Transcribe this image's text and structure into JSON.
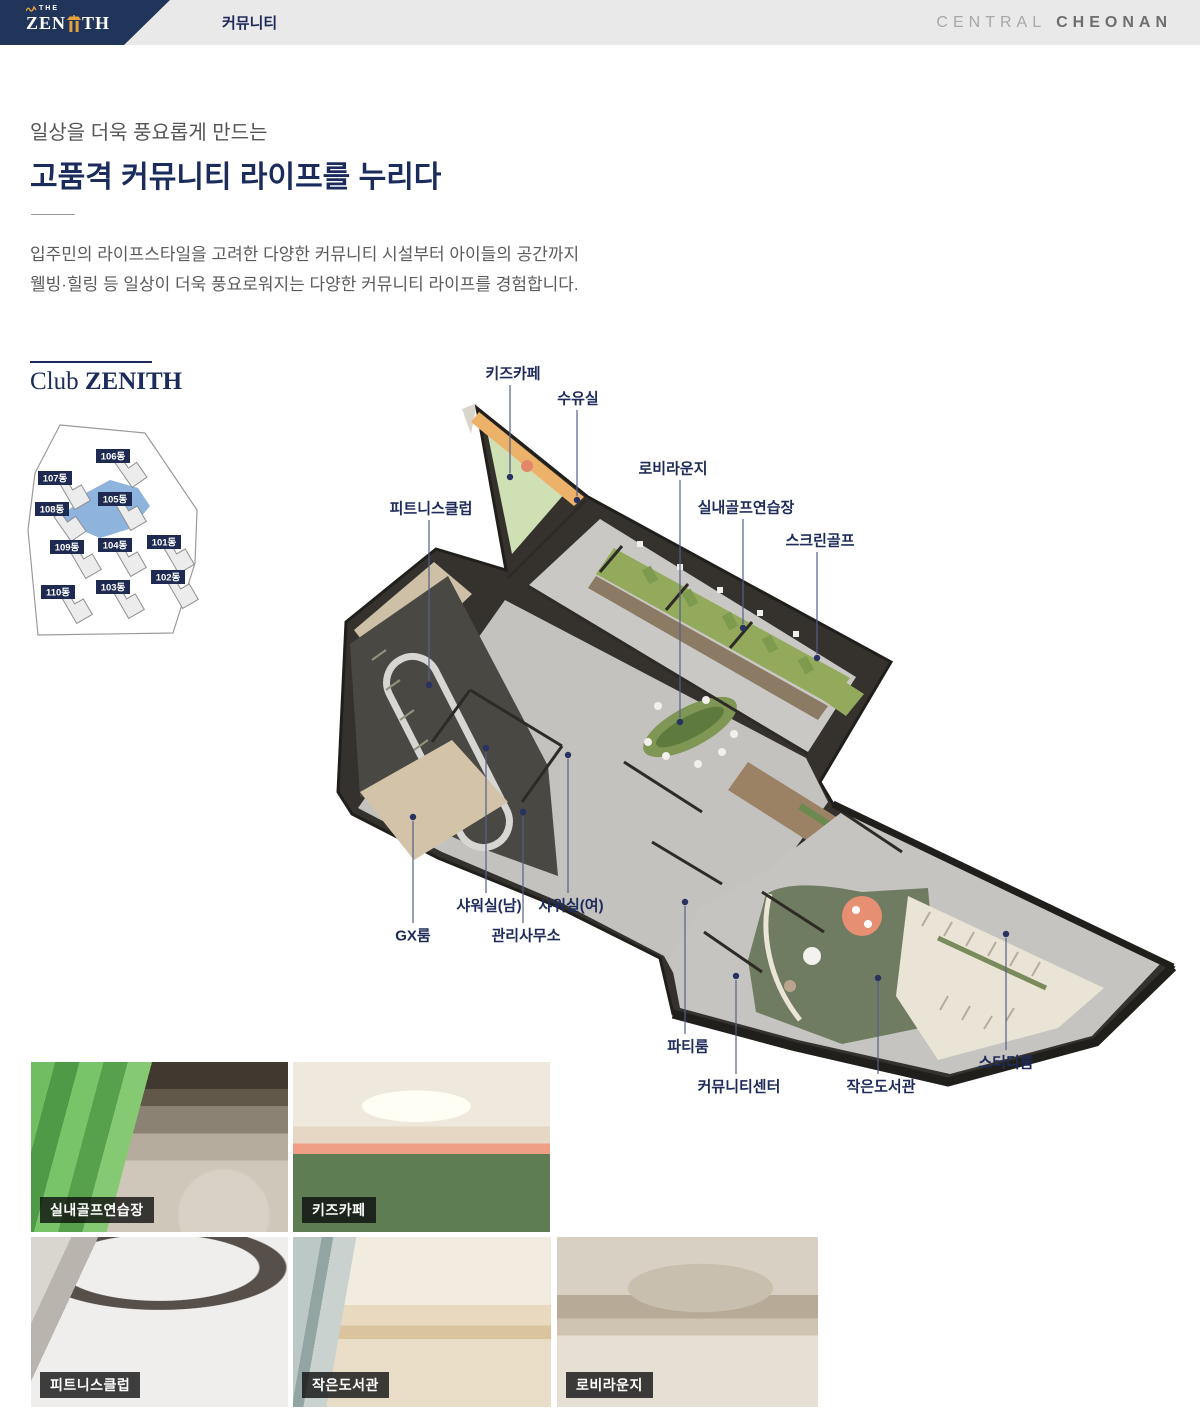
{
  "header": {
    "logo_the": "THE",
    "logo_zen": "ZEN",
    "logo_th": "TH",
    "tab": "커뮤니티",
    "brand_light": "CENTRAL",
    "brand_bold": "CHEONAN"
  },
  "intro": {
    "eyebrow": "일상을 더욱 풍요롭게 만드는",
    "title": "고품격 커뮤니티 라이프를 누리다",
    "body_line1": "입주민의 라이프스타일을 고려한 다양한 커뮤니티 시설부터 아이들의 공간까지",
    "body_line2": "웰빙·힐링 등 일상이 더욱 풍요로워지는 다양한 커뮤니티 라이프를 경험합니다."
  },
  "club": {
    "title_regular": "Club ",
    "title_bold": "ZENITH"
  },
  "site_map": {
    "highlighted": "105동",
    "buildings": [
      {
        "label": "106동",
        "x": 113,
        "y": 456,
        "gx": 131,
        "gy": 470,
        "rot": -35
      },
      {
        "label": "107동",
        "x": 55,
        "y": 478,
        "gx": 75,
        "gy": 492,
        "rot": -30
      },
      {
        "label": "105동",
        "x": 115,
        "y": 499,
        "gx": 131,
        "gy": 513,
        "rot": -30
      },
      {
        "label": "108동",
        "x": 52,
        "y": 509,
        "gx": 70,
        "gy": 524,
        "rot": -35
      },
      {
        "label": "109동",
        "x": 67,
        "y": 547,
        "gx": 86,
        "gy": 561,
        "rot": -30
      },
      {
        "label": "104동",
        "x": 115,
        "y": 545,
        "gx": 131,
        "gy": 559,
        "rot": -30
      },
      {
        "label": "101동",
        "x": 164,
        "y": 542,
        "gx": 179,
        "gy": 556,
        "rot": -30
      },
      {
        "label": "102동",
        "x": 168,
        "y": 577,
        "gx": 183,
        "gy": 591,
        "rot": -30
      },
      {
        "label": "103동",
        "x": 113,
        "y": 587,
        "gx": 129,
        "gy": 601,
        "rot": -30
      },
      {
        "label": "110동",
        "x": 58,
        "y": 592,
        "gx": 77,
        "gy": 606,
        "rot": -30
      }
    ]
  },
  "floor_plan": {
    "labels": [
      {
        "id": "kids-cafe",
        "text": "키즈카페",
        "lx": 513,
        "ly": 373,
        "dx": 510,
        "dy": 477
      },
      {
        "id": "nursing-room",
        "text": "수유실",
        "lx": 578,
        "ly": 398,
        "dx": 577,
        "dy": 500
      },
      {
        "id": "lobby-lounge",
        "text": "로비라운지",
        "lx": 673,
        "ly": 468,
        "dx": 680,
        "dy": 722
      },
      {
        "id": "indoor-golf-range",
        "text": "실내골프연습장",
        "lx": 746,
        "ly": 507,
        "dx": 743,
        "dy": 628
      },
      {
        "id": "screen-golf",
        "text": "스크린골프",
        "lx": 820,
        "ly": 540,
        "dx": 817,
        "dy": 658
      },
      {
        "id": "fitness-club",
        "text": "피트니스클럽",
        "lx": 431,
        "ly": 508,
        "dx": 429,
        "dy": 685
      },
      {
        "id": "shower-men",
        "text": "샤워실(남)",
        "lx": 489,
        "ly": 905,
        "dx": 486,
        "dy": 748
      },
      {
        "id": "shower-women",
        "text": "샤워실(여)",
        "lx": 571,
        "ly": 905,
        "dx": 568,
        "dy": 755
      },
      {
        "id": "gx-room",
        "text": "GX룸",
        "lx": 413,
        "ly": 935,
        "dx": 413,
        "dy": 817
      },
      {
        "id": "management-office",
        "text": "관리사무소",
        "lx": 526,
        "ly": 935,
        "dx": 523,
        "dy": 812
      },
      {
        "id": "party-room",
        "text": "파티룸",
        "lx": 688,
        "ly": 1046,
        "dx": 685,
        "dy": 902
      },
      {
        "id": "community-center",
        "text": "커뮤니티센터",
        "lx": 739,
        "ly": 1086,
        "dx": 736,
        "dy": 976
      },
      {
        "id": "small-library",
        "text": "작은도서관",
        "lx": 881,
        "ly": 1086,
        "dx": 878,
        "dy": 978
      },
      {
        "id": "study-room",
        "text": "스터디룸",
        "lx": 1006,
        "ly": 1062,
        "dx": 1006,
        "dy": 934
      }
    ]
  },
  "photos": [
    {
      "id": "indoor-golf-range",
      "label": "실내골프연습장",
      "scene": "golf",
      "x": 31,
      "y": 1062,
      "w": 257,
      "h": 170
    },
    {
      "id": "kids-cafe",
      "label": "키즈카페",
      "scene": "kids",
      "x": 293,
      "y": 1062,
      "w": 257,
      "h": 170
    },
    {
      "id": "fitness-club",
      "label": "피트니스클럽",
      "scene": "fitness",
      "x": 31,
      "y": 1237,
      "w": 257,
      "h": 170
    },
    {
      "id": "small-library",
      "label": "작은도서관",
      "scene": "library",
      "x": 293,
      "y": 1237,
      "w": 258,
      "h": 170
    },
    {
      "id": "lobby-lounge",
      "label": "로비라운지",
      "scene": "lobby",
      "x": 557,
      "y": 1237,
      "w": 261,
      "h": 170
    }
  ],
  "colors": {
    "header_navy": "#21355b",
    "accent_navy": "#1e2b5a",
    "title_navy": "#1b2c5c",
    "logo_gold": "#e3a23c",
    "map_highlight_blue": "#7aa7d8",
    "golf_green": "#93aa5c",
    "library_green": "#6f7c61"
  }
}
